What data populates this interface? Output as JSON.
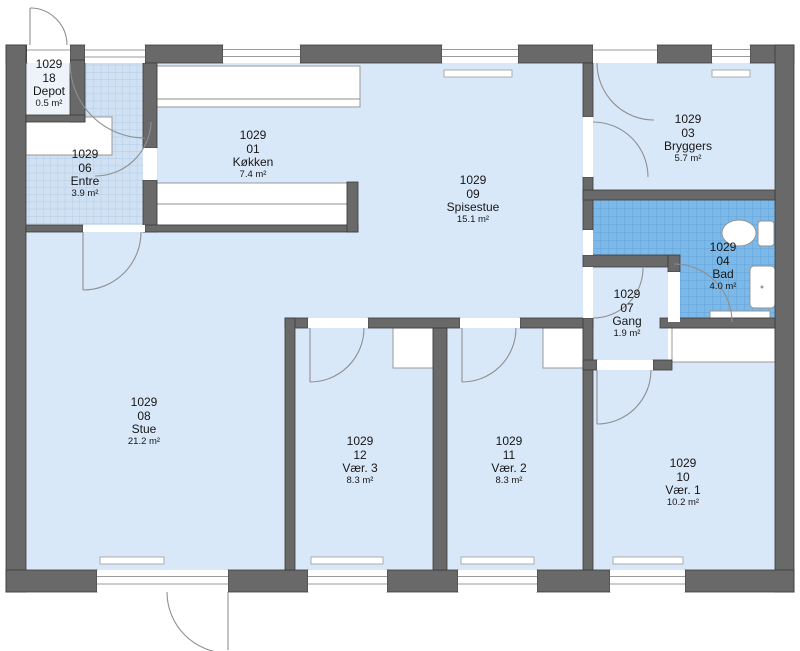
{
  "plan": {
    "unit_id": "1029",
    "colors": {
      "wall": "#696969",
      "floor": "#d9e8f9",
      "entre_tile": "#cfe1f3",
      "bath_tile": "#7db9e8",
      "fixture": "#ffffff"
    },
    "rooms": [
      {
        "unit": "1029",
        "number": "18",
        "name": "Depot",
        "area": "0.5 m²"
      },
      {
        "unit": "1029",
        "number": "06",
        "name": "Entre",
        "area": "3.9 m²"
      },
      {
        "unit": "1029",
        "number": "01",
        "name": "Køkken",
        "area": "7.4 m²"
      },
      {
        "unit": "1029",
        "number": "09",
        "name": "Spisestue",
        "area": "15.1 m²"
      },
      {
        "unit": "1029",
        "number": "03",
        "name": "Bryggers",
        "area": "5.7 m²"
      },
      {
        "unit": "1029",
        "number": "04",
        "name": "Bad",
        "area": "4.0 m²"
      },
      {
        "unit": "1029",
        "number": "07",
        "name": "Gang",
        "area": "1.9 m²"
      },
      {
        "unit": "1029",
        "number": "08",
        "name": "Stue",
        "area": "21.2 m²"
      },
      {
        "unit": "1029",
        "number": "12",
        "name": "Vær. 3",
        "area": "8.3 m²"
      },
      {
        "unit": "1029",
        "number": "11",
        "name": "Vær. 2",
        "area": "8.3 m²"
      },
      {
        "unit": "1029",
        "number": "10",
        "name": "Vær. 1",
        "area": "10.2 m²"
      }
    ]
  }
}
